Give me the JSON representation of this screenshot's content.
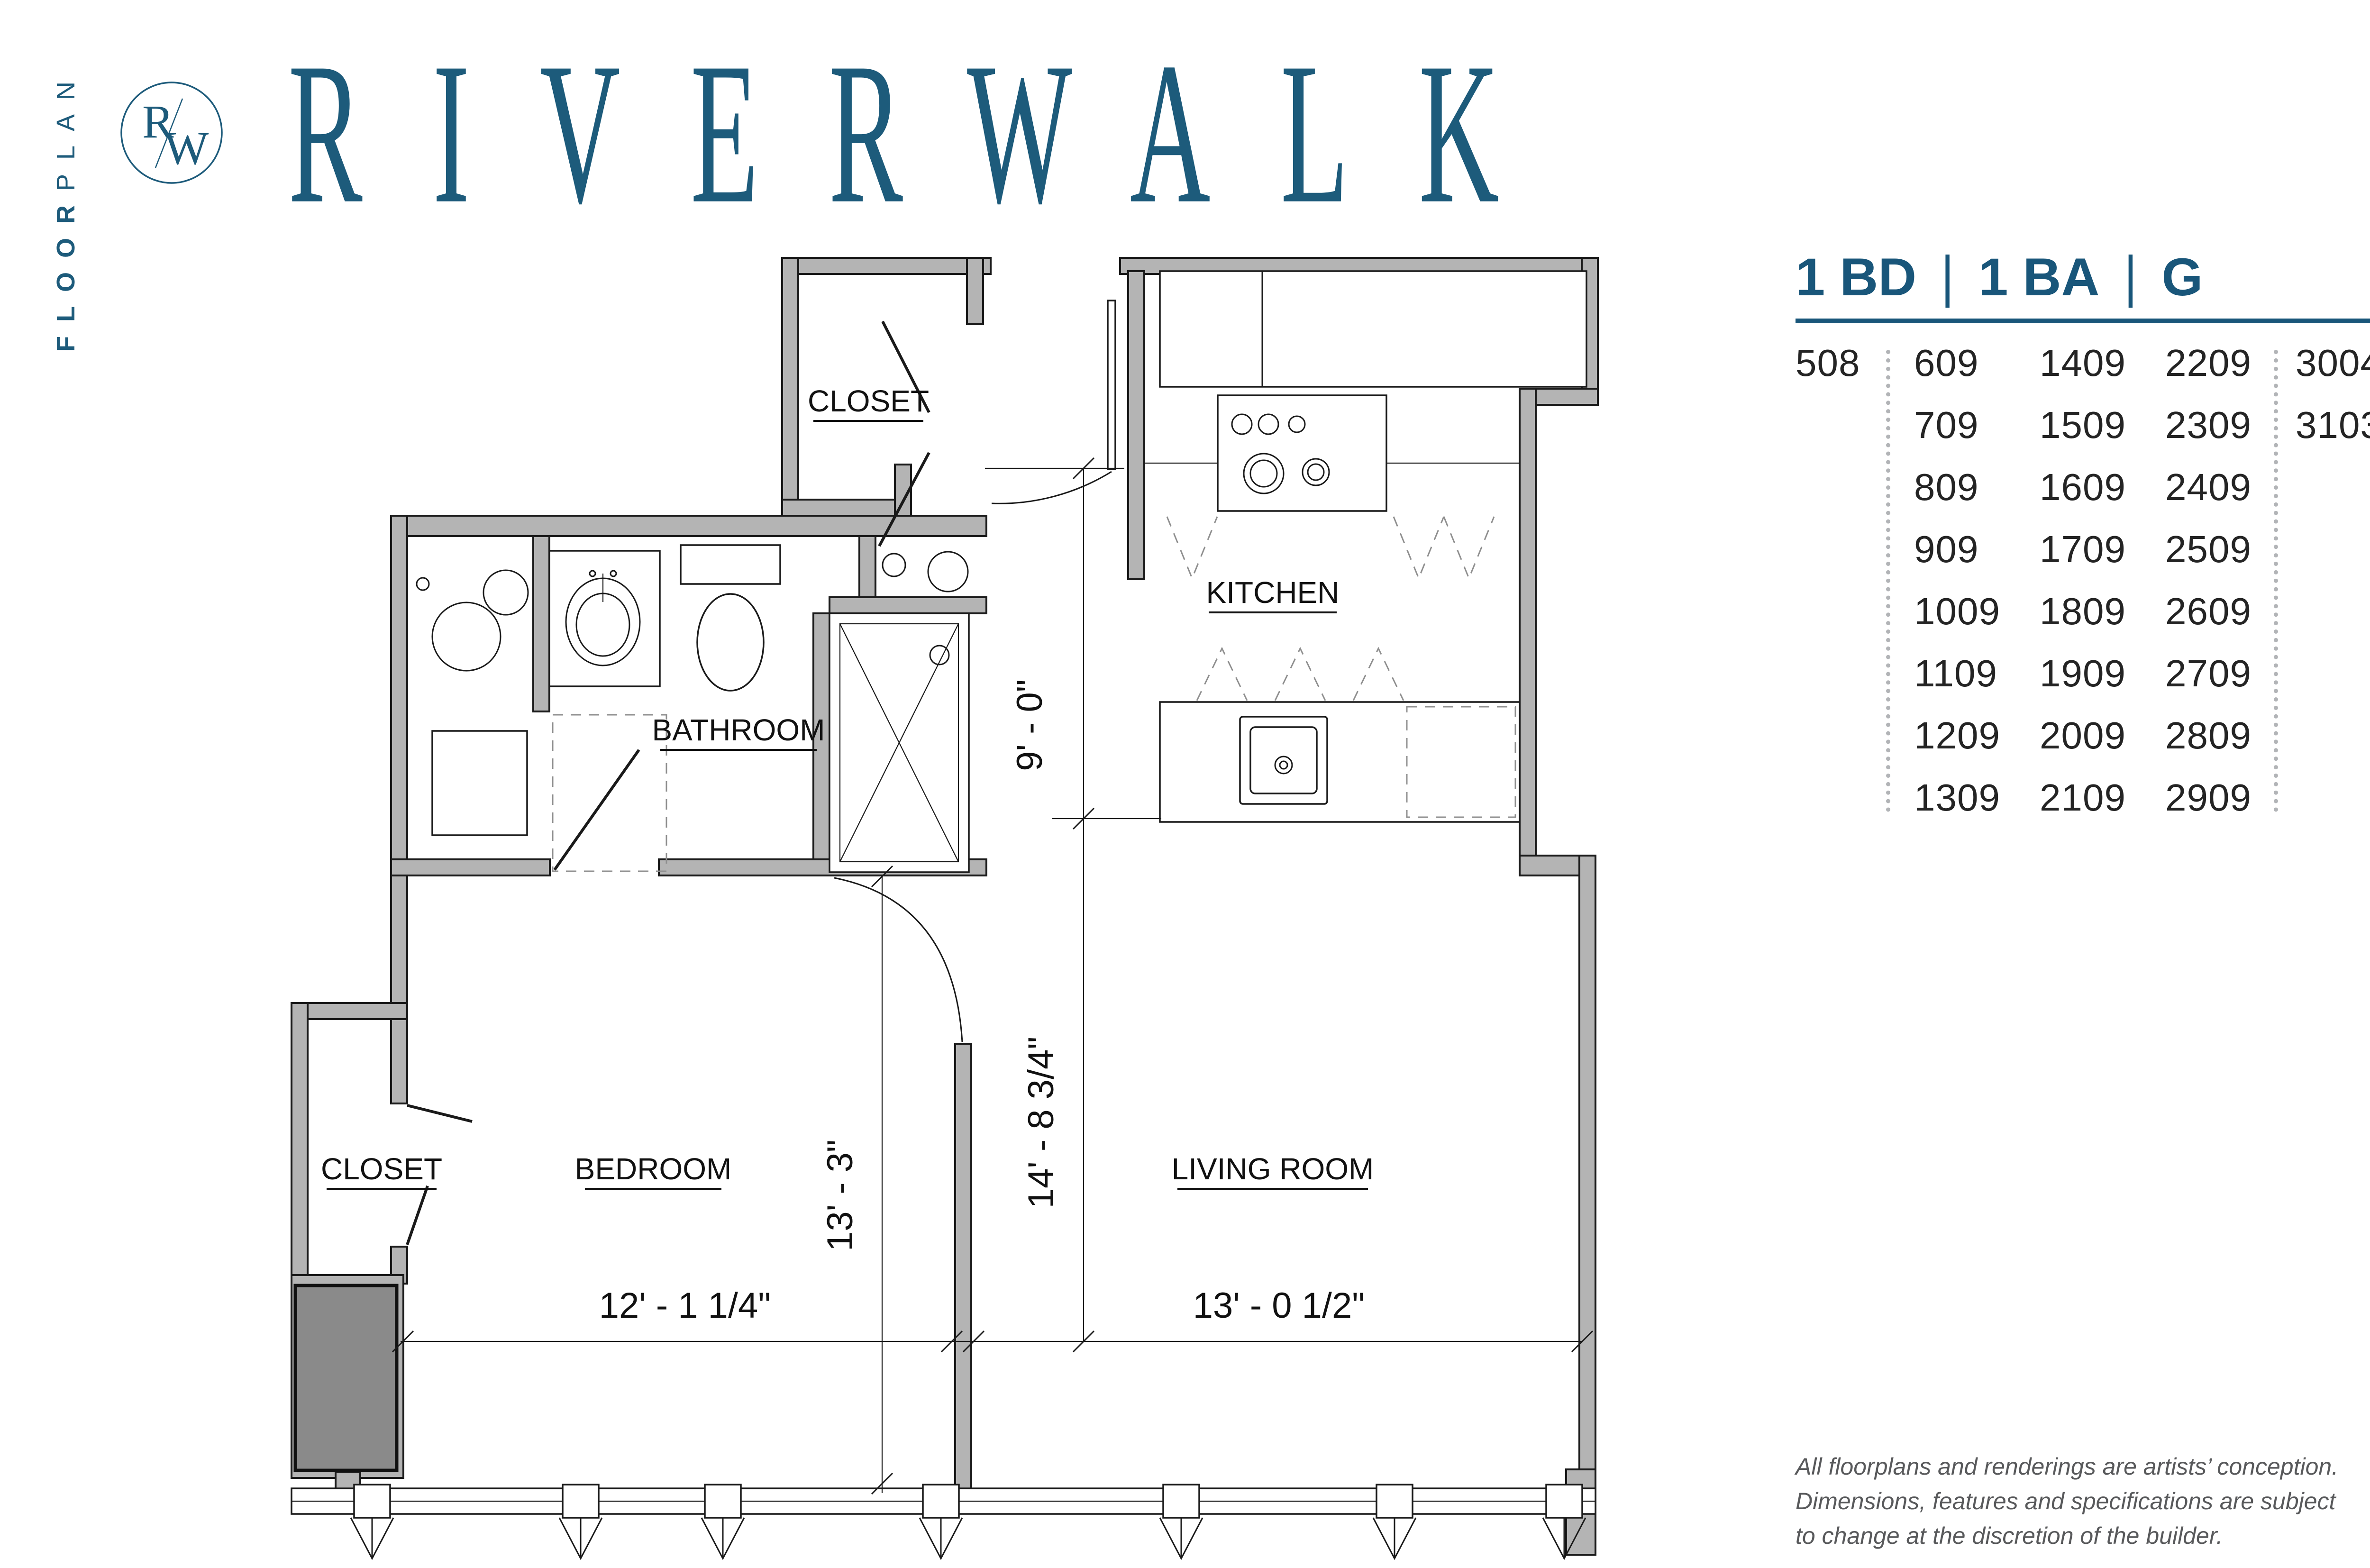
{
  "brand": {
    "vertical_label_bold": "FLOOR",
    "vertical_label_light": "PLAN",
    "logo_letter_r": "R",
    "logo_letter_w": "W",
    "title": "RIVERWALK",
    "accent_color": "#1d5b7b"
  },
  "unit_info": {
    "beds_label": "1 BD",
    "baths_label": "1 BA",
    "plan_letter": "G",
    "separator": "|"
  },
  "units": {
    "columns": [
      [
        "508"
      ],
      [
        "609",
        "709",
        "809",
        "909",
        "1009",
        "1109",
        "1209",
        "1309"
      ],
      [
        "1409",
        "1509",
        "1609",
        "1709",
        "1809",
        "1909",
        "2009",
        "2109"
      ],
      [
        "2209",
        "2309",
        "2409",
        "2509",
        "2609",
        "2709",
        "2809",
        "2909"
      ],
      [
        "3004",
        "3103"
      ]
    ]
  },
  "floorplan": {
    "rooms": {
      "closet_top": "CLOSET",
      "kitchen": "KITCHEN",
      "bathroom": "BATHROOM",
      "closet_lower": "CLOSET",
      "bedroom": "BEDROOM",
      "living_room": "LIVING ROOM"
    },
    "dimensions": {
      "kitchen_depth": "9' - 0\"",
      "living_depth": "14' - 8 3/4\"",
      "bedroom_depth": "13' - 3\"",
      "bedroom_width": "12' - 1 1/4\"",
      "living_width": "13' - 0 1/2\""
    }
  },
  "disclaimer": {
    "line1": "All floorplans and renderings are artists’ conception.",
    "line2": "Dimensions, features and specifications are subject",
    "line3": "to change at the discretion of the builder."
  }
}
